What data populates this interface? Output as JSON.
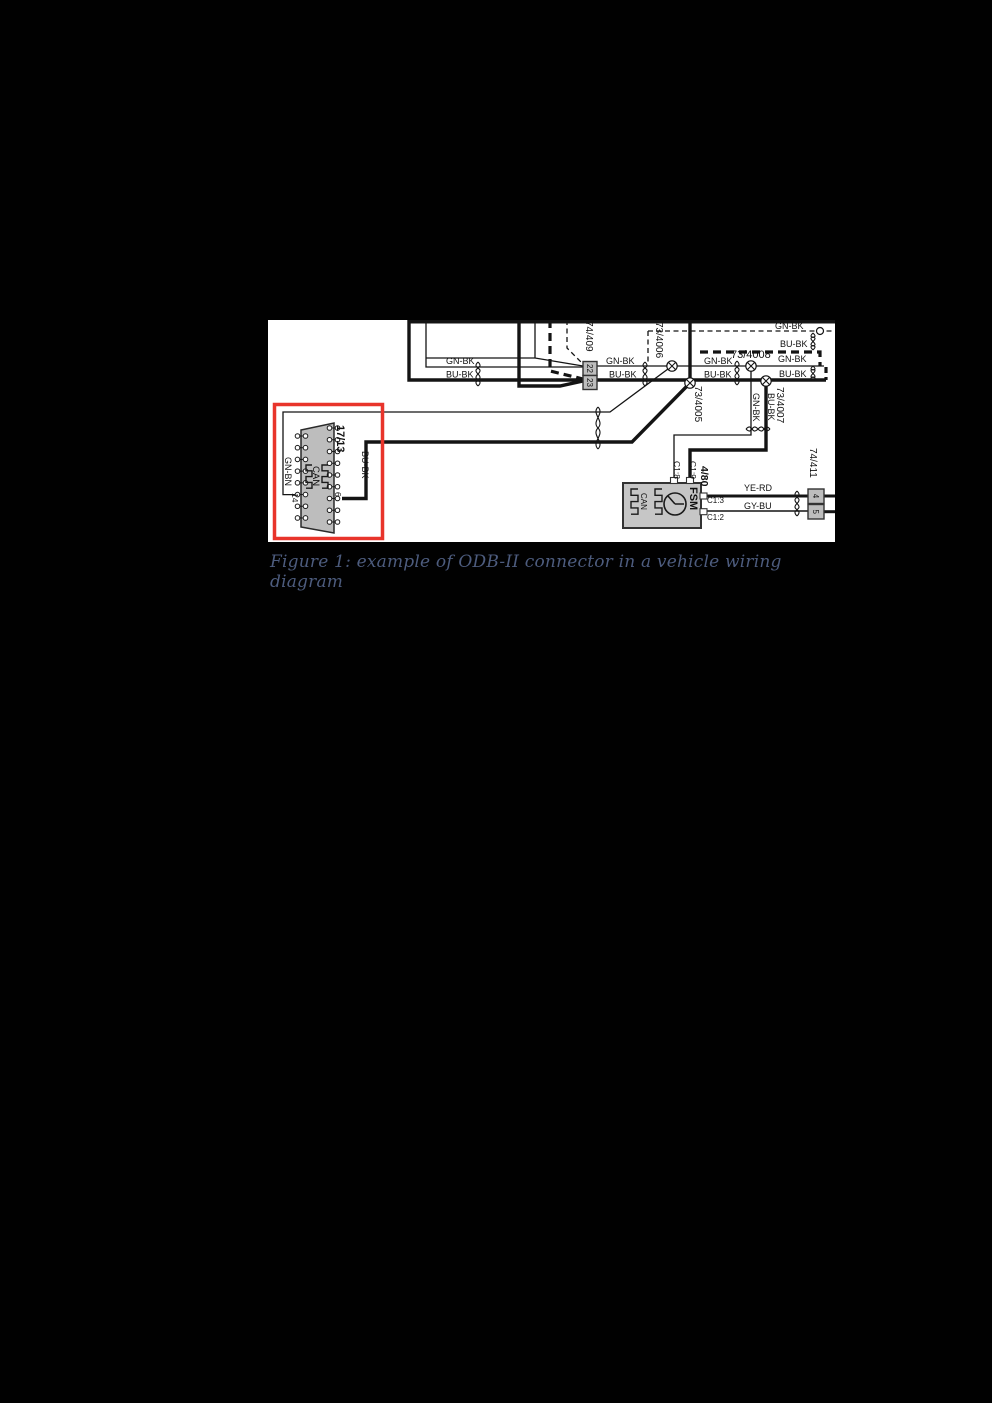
{
  "figure": {
    "kind": "vehicle-wiring-diagram",
    "caption": "Figure 1: example of ODB-II connector in a vehicle wiring diagram",
    "caption_color": "#4d5c7e",
    "highlight_box_color": "#e8342b",
    "panel_background": "#ffffff"
  },
  "diagram": {
    "labels": [
      {
        "id": "wire-label-gn-bk-left",
        "text": "GN-BK",
        "x": 446,
        "y": 364,
        "size": 9
      },
      {
        "id": "wire-label-bu-bk-left",
        "text": "BU-BK",
        "x": 446,
        "y": 377.5,
        "size": 9
      },
      {
        "id": "connector-74-409-label",
        "text": "74/409",
        "x": 586,
        "y": 321,
        "size": 10,
        "rot": 90
      },
      {
        "id": "pin-22-label",
        "text": "22",
        "x": 590,
        "y": 368.5,
        "size": 8,
        "rot": 90,
        "anchor": "middle"
      },
      {
        "id": "pin-23-label",
        "text": "23",
        "x": 590,
        "y": 382.5,
        "size": 8,
        "rot": 90,
        "anchor": "middle"
      },
      {
        "id": "wire-label-gn-bk-mid",
        "text": "GN-BK",
        "x": 606,
        "y": 364,
        "size": 9
      },
      {
        "id": "wire-label-bu-bk-mid",
        "text": "BU-BK",
        "x": 609,
        "y": 377.5,
        "size": 9
      },
      {
        "id": "splice-73-4006-label",
        "text": "73/4006",
        "x": 656,
        "y": 322,
        "size": 10,
        "rot": 90
      },
      {
        "id": "splice-73-4005-label",
        "text": "73/4005",
        "x": 695,
        "y": 386,
        "size": 10,
        "rot": 90
      },
      {
        "id": "splice-73-4008-label",
        "text": "73/4008",
        "x": 731,
        "y": 358,
        "size": 11
      },
      {
        "id": "wire-label-gn-bk-right1",
        "text": "GN-BK",
        "x": 704,
        "y": 364,
        "size": 9
      },
      {
        "id": "wire-label-bu-bk-right1",
        "text": "BU-BK",
        "x": 704,
        "y": 377.5,
        "size": 9
      },
      {
        "id": "wire-label-gn-bk-right2",
        "text": "GN-BK",
        "x": 778,
        "y": 362,
        "size": 9
      },
      {
        "id": "wire-label-bu-bk-right2",
        "text": "BU-BK",
        "x": 779,
        "y": 377,
        "size": 9
      },
      {
        "id": "wire-label-gn-bk-dashed",
        "text": "GN-BK",
        "x": 775,
        "y": 329,
        "size": 9
      },
      {
        "id": "wire-label-bu-bk-dashed",
        "text": "BU-BK",
        "x": 780,
        "y": 347,
        "size": 9
      },
      {
        "id": "wire-label-gn-bk-drop",
        "text": "GN-BK",
        "x": 753,
        "y": 393,
        "size": 9,
        "rot": 90
      },
      {
        "id": "wire-label-bu-bk-drop",
        "text": "BU-BK",
        "x": 768,
        "y": 393,
        "size": 9,
        "rot": 90
      },
      {
        "id": "splice-73-4007-label",
        "text": "73/4007",
        "x": 777,
        "y": 387,
        "size": 10,
        "rot": 90
      },
      {
        "id": "fsm-pin-c1-8-label",
        "text": "C1:8",
        "x": 674,
        "y": 461,
        "size": 8.5,
        "rot": 90
      },
      {
        "id": "fsm-pin-c1-9-label",
        "text": "C1:9",
        "x": 690,
        "y": 461,
        "size": 8.5,
        "rot": 90
      },
      {
        "id": "fsm-component-number-label",
        "text": "4/80",
        "x": 701,
        "y": 466,
        "size": 10.5,
        "rot": 90,
        "bold": true
      },
      {
        "id": "fsm-name-label",
        "text": "FSM",
        "x": 690,
        "y": 487,
        "size": 11,
        "rot": 90,
        "bold": true
      },
      {
        "id": "fsm-can-label",
        "text": "CAN",
        "x": 641,
        "y": 493,
        "size": 8,
        "rot": 90
      },
      {
        "id": "fsm-pin-c1-3-label",
        "text": "C1:3",
        "x": 707,
        "y": 503,
        "size": 8
      },
      {
        "id": "fsm-pin-c1-2-label",
        "text": "C1:2",
        "x": 707,
        "y": 520,
        "size": 8
      },
      {
        "id": "wire-label-ye-rd",
        "text": "YE-RD",
        "x": 744,
        "y": 491,
        "size": 9
      },
      {
        "id": "wire-label-gy-bu",
        "text": "GY-BU",
        "x": 744,
        "y": 509,
        "size": 9
      },
      {
        "id": "connector-74-411-label",
        "text": "74/411",
        "x": 810,
        "y": 448,
        "size": 10,
        "rot": 90
      },
      {
        "id": "pin-4-label",
        "text": "4",
        "x": 816,
        "y": 496,
        "size": 8,
        "rot": 90,
        "anchor": "middle"
      },
      {
        "id": "pin-5-label",
        "text": "5",
        "x": 816,
        "y": 511.7,
        "size": 8,
        "rot": 90,
        "anchor": "middle"
      },
      {
        "id": "obd-connector-17-13-label",
        "text": "17/13",
        "x": 337,
        "y": 425,
        "size": 11,
        "rot": 90,
        "bold": true
      },
      {
        "id": "wire-label-gn-bn-obd",
        "text": "GN-BN",
        "x": 285,
        "y": 457,
        "size": 9,
        "rot": 90
      },
      {
        "id": "wire-label-bu-bk-obd",
        "text": "BU-BK",
        "x": 362,
        "y": 451,
        "size": 9,
        "rot": 90
      },
      {
        "id": "obd-can-label",
        "text": "CAN",
        "x": 313,
        "y": 466,
        "size": 9.5,
        "rot": 90
      },
      {
        "id": "obd-pin-14-label",
        "text": "14",
        "x": 292,
        "y": 493,
        "size": 8.5,
        "rot": 90
      },
      {
        "id": "obd-pin-6-label",
        "text": "6",
        "x": 335,
        "y": 492,
        "size": 8.5,
        "rot": 90
      }
    ]
  }
}
